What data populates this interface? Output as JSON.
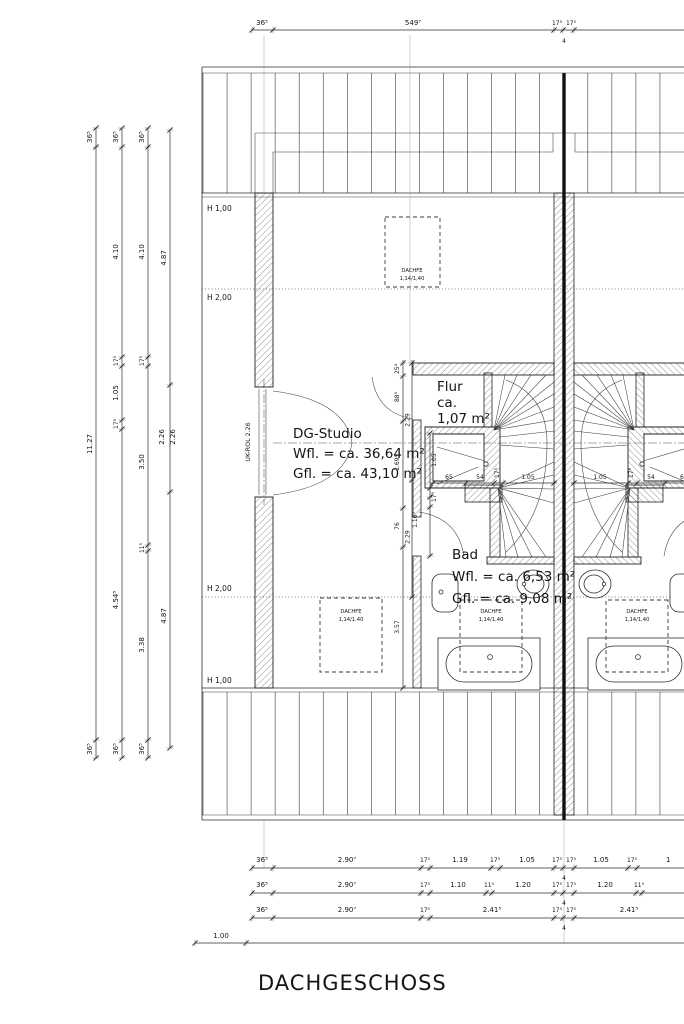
{
  "title": "DACHGESCHOSS",
  "rooms": {
    "studio": {
      "name": "DG-Studio",
      "wfl": "Wfl. = ca. 36,64 m²",
      "gfl": "Gfl. = ca. 43,10 m²"
    },
    "flur": {
      "name": "Flur",
      "area_prefix": "ca.",
      "area": "1,07 m²"
    },
    "bad": {
      "name": "Bad",
      "wfl": "Wfl. = ca. 6,53 m²",
      "gfl": "Gfl. = ca. 9,08 m²"
    }
  },
  "labels": {
    "h_100": "H 1,00",
    "h_200": "H 2,00",
    "uk_rol": "UK-ROL 2.26",
    "roof_window": "DACHFE",
    "roof_window_size": "1,14/1,40"
  },
  "dims": {
    "top": [
      "36⁵",
      "549⁷",
      "17⁵",
      "17⁵",
      "4"
    ],
    "left1": [
      "36⁵",
      "11.27",
      "36⁵"
    ],
    "left2": [
      "36⁵",
      "4.10",
      "17⁵",
      "1.05",
      "17⁵",
      "4.54⁵",
      "36⁵"
    ],
    "left3": [
      "36⁵",
      "4.10",
      "17⁵",
      "3.50",
      "11⁵",
      "3.38",
      "36⁵"
    ],
    "left4": [
      "4.87",
      "2.26",
      "2.26",
      "4.87"
    ],
    "bottom1": [
      "36⁵",
      "2.90⁷",
      "17⁵",
      "1.19",
      "17⁵",
      "1.05",
      "17⁵",
      "17⁵",
      "1.05",
      "17⁵",
      "1",
      "4"
    ],
    "bottom2": [
      "36⁵",
      "2.90⁷",
      "17⁵",
      "1.10",
      "11⁵",
      "1.20",
      "17⁵",
      "17⁵",
      "1.20",
      "11⁵",
      "4"
    ],
    "bottom3": [
      "36⁵",
      "2.90⁷",
      "17⁵",
      "2.41⁵",
      "17⁵",
      "17⁵",
      "2.41⁵",
      "4"
    ],
    "bottom4": [
      "1.00"
    ],
    "stair_left": [
      "65",
      "54",
      "17⁵",
      "1.05"
    ],
    "stair_right": [
      "1.05",
      "17⁵",
      "54",
      "65"
    ],
    "inner_a": [
      "25⁴",
      "88⁵",
      "1.69⁴",
      "76",
      "3.57"
    ],
    "inner_b": [
      "2.29",
      "2.29"
    ],
    "wall": [
      "1.05",
      "17⁵",
      "1.16⁵"
    ]
  },
  "colors": {
    "ink": "#2b2b2b",
    "paper": "#ffffff"
  }
}
